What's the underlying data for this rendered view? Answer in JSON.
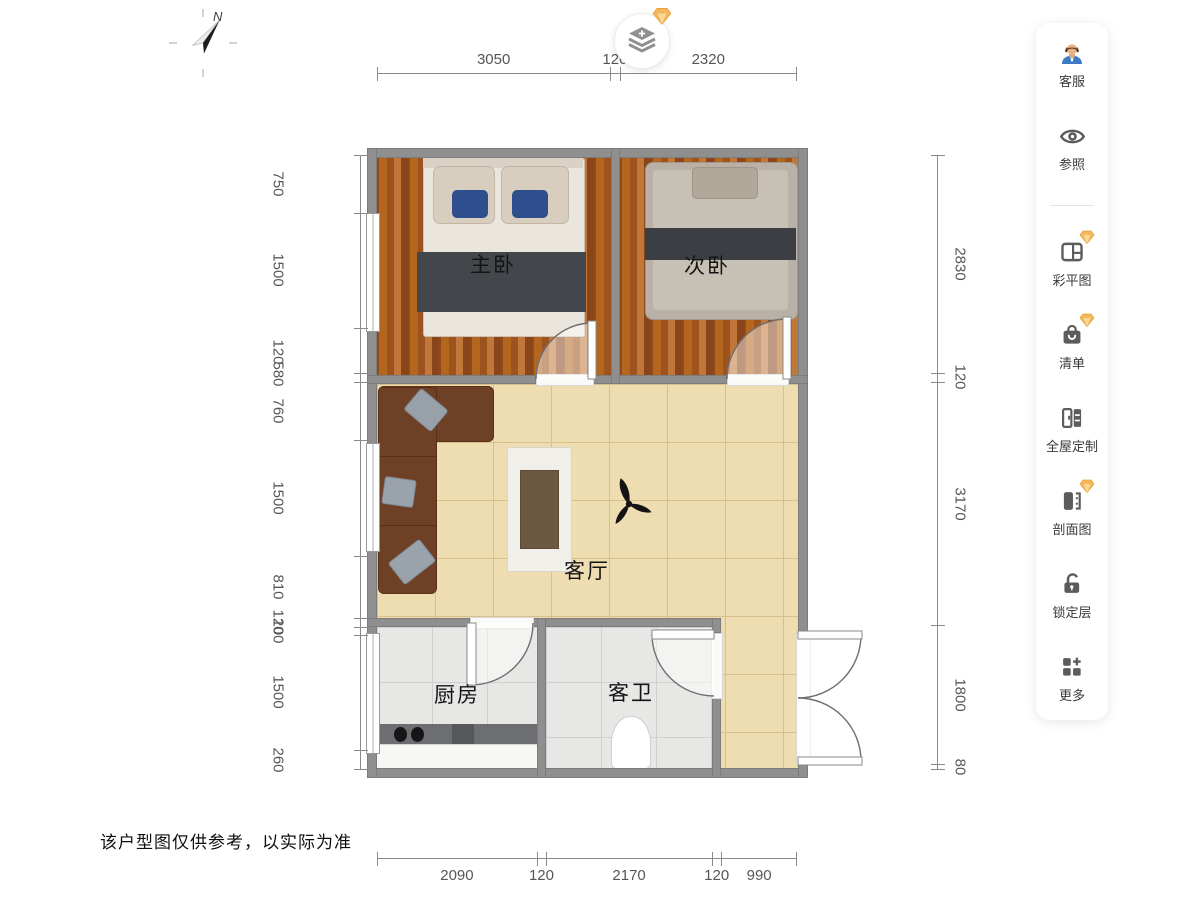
{
  "disclaimer": "该户型图仅供参考，以实际为准",
  "compass": {
    "north_label": "N"
  },
  "top_button": {
    "icon": "layers-plus",
    "premium_badge": "gem"
  },
  "sidebar": {
    "items": [
      {
        "label": "客服",
        "icon": "customer-service",
        "premium": false
      },
      {
        "label": "参照",
        "icon": "reference-eye",
        "premium": false
      },
      {
        "label": "彩平图",
        "icon": "color-plan",
        "premium": true
      },
      {
        "label": "清单",
        "icon": "list-bag",
        "premium": true
      },
      {
        "label": "全屋定制",
        "icon": "custom-cabinet",
        "premium": false
      },
      {
        "label": "剖面图",
        "icon": "section-view",
        "premium": true
      },
      {
        "label": "锁定层",
        "icon": "unlock-layer",
        "premium": false
      },
      {
        "label": "更多",
        "icon": "more-grid",
        "premium": false
      }
    ]
  },
  "rooms": {
    "master_bedroom": "主卧",
    "second_bedroom": "次卧",
    "living_room": "客厅",
    "kitchen": "厨房",
    "guest_bathroom": "客卫"
  },
  "dimensions": {
    "top": [
      "3050",
      "120",
      "2320"
    ],
    "bottom": [
      "2090",
      "120",
      "2170",
      "120",
      "990"
    ],
    "left": [
      "750",
      "1500",
      "580",
      "120",
      "760",
      "1500",
      "810",
      "120",
      "100",
      "1500",
      "260"
    ],
    "right": [
      "2830",
      "120",
      "3170",
      "1800",
      "80"
    ]
  },
  "colors": {
    "wall": "#8f8f8f",
    "wood_floor": "#a2571d",
    "tile_floor": "#efddb2",
    "marble_floor": "#e7e7e5",
    "premium_gem": "#f4b75b",
    "dimension_text": "#565656"
  }
}
